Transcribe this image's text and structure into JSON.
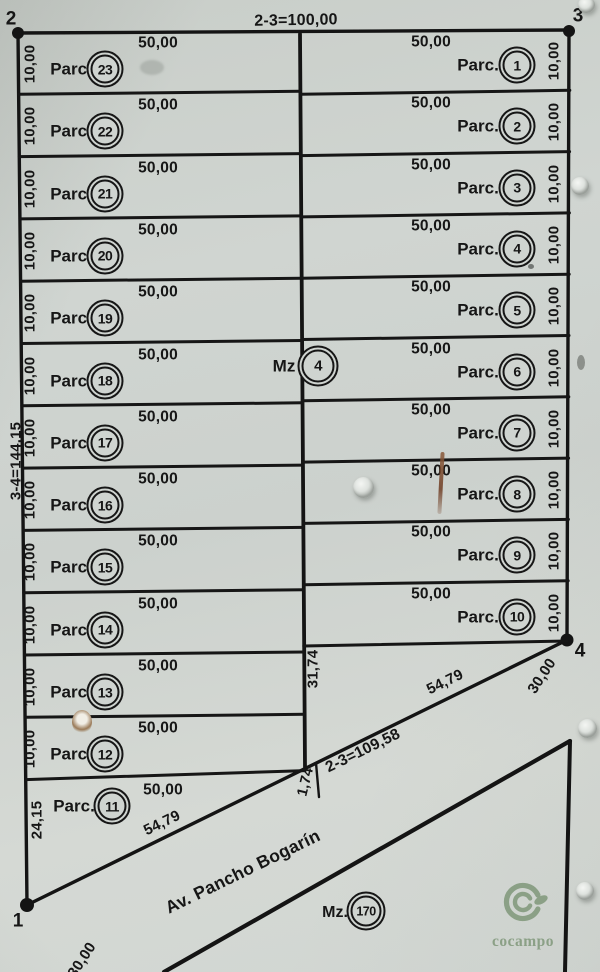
{
  "corner_points": {
    "p2": "2",
    "p3": "3",
    "p4": "4",
    "p1": "1"
  },
  "boundary_labels": {
    "top": "2-3=100,00",
    "left": "3-4=144,15",
    "avenue_line": "2-3=109,58"
  },
  "parcel": {
    "prefix": "Parc.",
    "front_label": "50,00",
    "depth_label": "10,00",
    "left_numbers": [
      "23",
      "22",
      "21",
      "20",
      "19",
      "18",
      "17",
      "16",
      "15",
      "14",
      "13",
      "12",
      "11"
    ],
    "right_numbers": [
      "1",
      "2",
      "3",
      "4",
      "5",
      "6",
      "7",
      "8",
      "9",
      "10"
    ],
    "parcel11": {
      "side": "24,15",
      "front": "50,00",
      "hypotenuse": "54,79"
    }
  },
  "block": {
    "label": "Mz",
    "number": "4"
  },
  "neighbor_block": {
    "label": "Mz.",
    "number": "170"
  },
  "avenue": {
    "name": "Av. Pancho Bogarín",
    "segment_right": "54,79",
    "center_offset": "31,74",
    "tick_offset": "1,74",
    "width_at_p4": "30,00",
    "width_at_p1": "30,00"
  },
  "logo": {
    "text": "cocampo",
    "color": "#8ba086"
  }
}
